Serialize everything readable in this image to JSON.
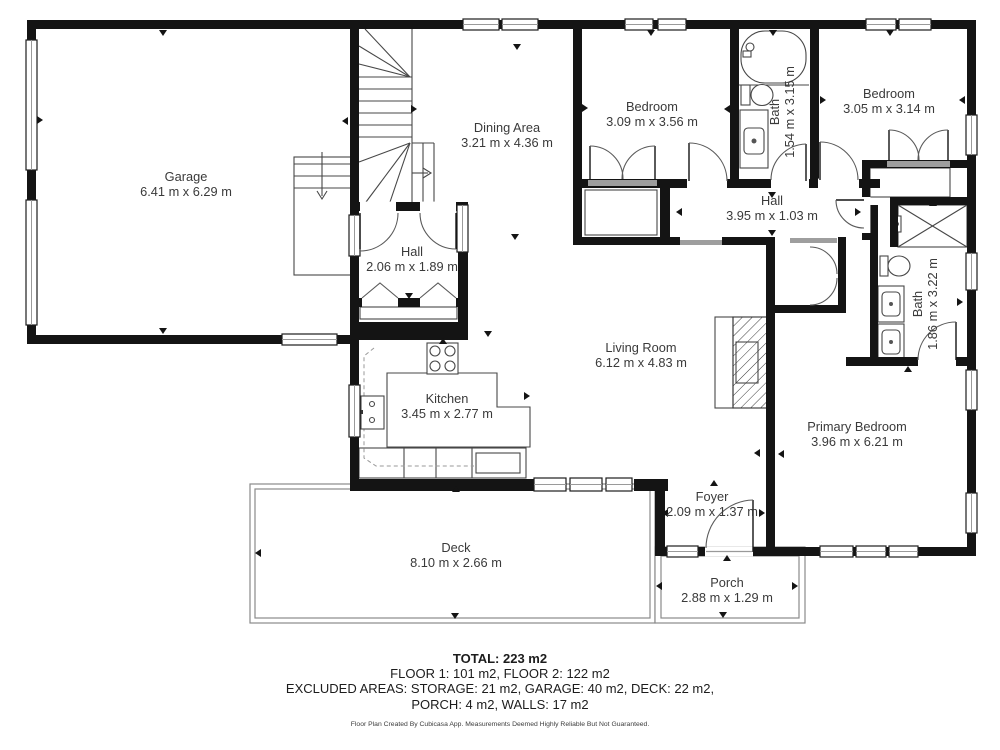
{
  "rooms": [
    {
      "id": "garage",
      "name": "Garage",
      "dims": "6.41 m x 6.29 m"
    },
    {
      "id": "dining-area",
      "name": "Dining Area",
      "dims": "3.21 m x 4.36 m"
    },
    {
      "id": "bedroom-1",
      "name": "Bedroom",
      "dims": "3.09 m x 3.56 m"
    },
    {
      "id": "bath-1",
      "name": "Bath",
      "dims": "1.54 m x 3.15 m"
    },
    {
      "id": "bedroom-2",
      "name": "Bedroom",
      "dims": "3.05 m x 3.14 m"
    },
    {
      "id": "hall",
      "name": "Hall",
      "dims": "3.95 m x 1.03 m"
    },
    {
      "id": "hall-small",
      "name": "Hall",
      "dims": "2.06 m x 1.89 m"
    },
    {
      "id": "bath-2",
      "name": "Bath",
      "dims": "1.86 m x 3.22 m"
    },
    {
      "id": "living-room",
      "name": "Living Room",
      "dims": "6.12 m x 4.83 m"
    },
    {
      "id": "kitchen",
      "name": "Kitchen",
      "dims": "3.45 m x 2.77 m"
    },
    {
      "id": "primary-bedroom",
      "name": "Primary Bedroom",
      "dims": "3.96 m x 6.21 m"
    },
    {
      "id": "foyer",
      "name": "Foyer",
      "dims": "2.09 m x 1.37 m"
    },
    {
      "id": "deck",
      "name": "Deck",
      "dims": "8.10 m x 2.66 m"
    },
    {
      "id": "porch",
      "name": "Porch",
      "dims": "2.88 m x 1.29 m"
    }
  ],
  "footer": {
    "total": "TOTAL: 223 m2",
    "line2": "FLOOR 1: 101 m2, FLOOR 2: 122 m2",
    "line3": "EXCLUDED AREAS: STORAGE: 21 m2, GARAGE: 40 m2, DECK: 22 m2,",
    "line4": "PORCH: 4 m2, WALLS: 17 m2",
    "disclaimer": "Floor Plan Created By Cubicasa App. Measurements Deemed Highly Reliable But Not Guaranteed."
  },
  "colors": {
    "wall": "#141414",
    "label": "#3a3a3a",
    "fixture": "#474747",
    "threshold": "#9e9e9e",
    "marker": "#141414",
    "background": "#ffffff"
  }
}
